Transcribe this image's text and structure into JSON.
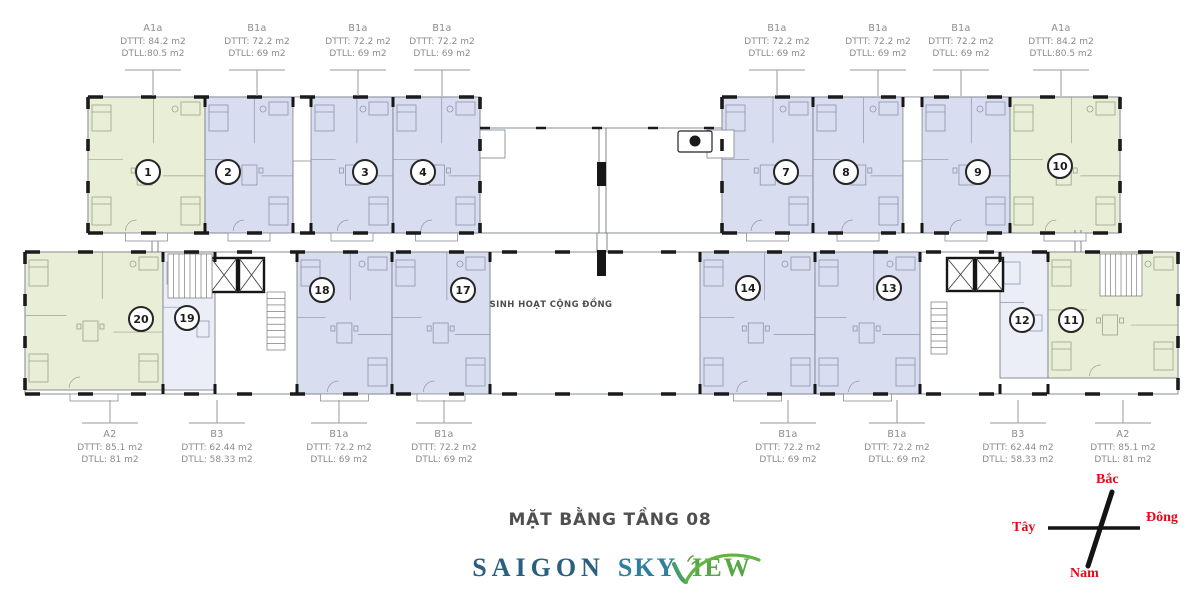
{
  "page": {
    "title": "MẶT BẰNG TẦNG 08",
    "community_room_label": "SINH HOẠT CỘNG ĐỒNG"
  },
  "logo": {
    "word1": "SAIGON",
    "word2_prefix": "SKY",
    "word2_suffix": "IEW"
  },
  "compass": {
    "north": "Bắc",
    "south": "Nam",
    "east": "Đông",
    "west": "Tây"
  },
  "colors": {
    "unit_green": "#e9eed7",
    "unit_blue": "#d8ddef",
    "unit_light": "#eceef7",
    "compass_red": "#e30918",
    "logo_navy": "#2b5f7e",
    "logo_teal": "#2f7fa0",
    "logo_green": "#55a845",
    "wall_black": "#1b1b1b"
  },
  "unit_labels_top": [
    {
      "type": "A1a",
      "dttt": "DTTT: 84.2 m2",
      "dtll": "DTLL:80.5 m2"
    },
    {
      "type": "B1a",
      "dttt": "DTTT: 72.2 m2",
      "dtll": "DTLL: 69 m2"
    },
    {
      "type": "B1a",
      "dttt": "DTTT: 72.2 m2",
      "dtll": "DTLL: 69 m2"
    },
    {
      "type": "B1a",
      "dttt": "DTTT: 72.2 m2",
      "dtll": "DTLL: 69 m2"
    },
    {
      "type": "B1a",
      "dttt": "DTTT: 72.2 m2",
      "dtll": "DTLL: 69 m2"
    },
    {
      "type": "B1a",
      "dttt": "DTTT: 72.2 m2",
      "dtll": "DTLL: 69 m2"
    },
    {
      "type": "B1a",
      "dttt": "DTTT: 72.2 m2",
      "dtll": "DTLL: 69 m2"
    },
    {
      "type": "A1a",
      "dttt": "DTTT: 84.2 m2",
      "dtll": "DTLL:80.5 m2"
    }
  ],
  "unit_labels_bottom": [
    {
      "type": "A2",
      "dttt": "DTTT: 85.1 m2",
      "dtll": "DTLL: 81 m2"
    },
    {
      "type": "B3",
      "dttt": "DTTT: 62.44 m2",
      "dtll": "DTLL: 58.33 m2"
    },
    {
      "type": "B1a",
      "dttt": "DTTT: 72.2 m2",
      "dtll": "DTLL: 69 m2"
    },
    {
      "type": "B1a",
      "dttt": "DTTT: 72.2 m2",
      "dtll": "DTLL: 69 m2"
    },
    {
      "type": "B1a",
      "dttt": "DTTT: 72.2 m2",
      "dtll": "DTLL: 69 m2"
    },
    {
      "type": "B1a",
      "dttt": "DTTT: 72.2 m2",
      "dtll": "DTLL: 69 m2"
    },
    {
      "type": "B3",
      "dttt": "DTTT: 62.44 m2",
      "dtll": "DTLL: 58.33 m2"
    },
    {
      "type": "A2",
      "dttt": "DTTT: 85.1 m2",
      "dtll": "DTLL: 81 m2"
    }
  ],
  "units_top": [
    {
      "number": "1",
      "type": "A1a"
    },
    {
      "number": "2",
      "type": "B1a"
    },
    {
      "number": "3",
      "type": "B1a"
    },
    {
      "number": "4",
      "type": "B1a"
    },
    {
      "number": "7",
      "type": "B1a"
    },
    {
      "number": "8",
      "type": "B1a"
    },
    {
      "number": "9",
      "type": "B1a"
    },
    {
      "number": "10",
      "type": "A1a"
    }
  ],
  "units_bottom": [
    {
      "number": "20",
      "type": "A2"
    },
    {
      "number": "19",
      "type": "B3"
    },
    {
      "number": "18",
      "type": "B1a"
    },
    {
      "number": "17",
      "type": "B1a"
    },
    {
      "number": "14",
      "type": "B1a"
    },
    {
      "number": "13",
      "type": "B1a"
    },
    {
      "number": "12",
      "type": "B3"
    },
    {
      "number": "11",
      "type": "A2"
    }
  ]
}
